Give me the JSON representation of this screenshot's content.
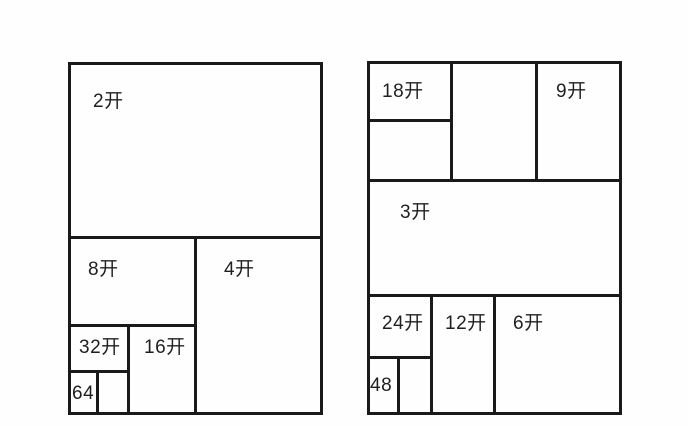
{
  "page": {
    "background": "#fefefe",
    "line_color": "#1a1a1a",
    "text_color": "#1f1f1f"
  },
  "diagrams": [
    {
      "name": "left-sheet",
      "frame": {
        "x": 68,
        "y": 62,
        "w": 255,
        "h": 353
      },
      "labels": [
        {
          "name": "region-2kai",
          "text": "2开",
          "x": 93,
          "y": 92
        },
        {
          "name": "region-8kai",
          "text": "8开",
          "x": 88,
          "y": 260
        },
        {
          "name": "region-4kai",
          "text": "4开",
          "x": 224,
          "y": 260
        },
        {
          "name": "region-32kai",
          "text": "32开",
          "x": 79,
          "y": 338
        },
        {
          "name": "region-16kai",
          "text": "16开",
          "x": 144,
          "y": 338
        },
        {
          "name": "region-64",
          "text": "64",
          "x": 72,
          "y": 384
        }
      ],
      "h_lines": [
        {
          "y": 236,
          "x1": 68,
          "x2": 323
        },
        {
          "y": 324,
          "x1": 68,
          "x2": 197
        },
        {
          "y": 370,
          "x1": 68,
          "x2": 130
        }
      ],
      "v_lines": [
        {
          "x": 194,
          "y1": 236,
          "y2": 415
        },
        {
          "x": 127,
          "y1": 324,
          "y2": 415
        },
        {
          "x": 96,
          "y1": 370,
          "y2": 415
        }
      ]
    },
    {
      "name": "right-sheet",
      "frame": {
        "x": 367,
        "y": 61,
        "w": 255,
        "h": 354
      },
      "labels": [
        {
          "name": "region-18kai",
          "text": "18开",
          "x": 382,
          "y": 82
        },
        {
          "name": "region-9kai",
          "text": "9开",
          "x": 556,
          "y": 82
        },
        {
          "name": "region-3kai",
          "text": "3开",
          "x": 400,
          "y": 203
        },
        {
          "name": "region-24kai",
          "text": "24开",
          "x": 382,
          "y": 314
        },
        {
          "name": "region-12kai",
          "text": "12开",
          "x": 445,
          "y": 314
        },
        {
          "name": "region-6kai",
          "text": "6开",
          "x": 513,
          "y": 314
        },
        {
          "name": "region-48",
          "text": "48",
          "x": 370,
          "y": 376
        }
      ],
      "h_lines": [
        {
          "y": 119,
          "x1": 367,
          "x2": 453
        },
        {
          "y": 179,
          "x1": 367,
          "x2": 622
        },
        {
          "y": 294,
          "x1": 367,
          "x2": 622
        },
        {
          "y": 356,
          "x1": 367,
          "x2": 433
        }
      ],
      "v_lines": [
        {
          "x": 450,
          "y1": 61,
          "y2": 182
        },
        {
          "x": 535,
          "y1": 61,
          "y2": 182
        },
        {
          "x": 430,
          "y1": 294,
          "y2": 415
        },
        {
          "x": 493,
          "y1": 294,
          "y2": 415
        },
        {
          "x": 397,
          "y1": 356,
          "y2": 415
        }
      ]
    }
  ]
}
